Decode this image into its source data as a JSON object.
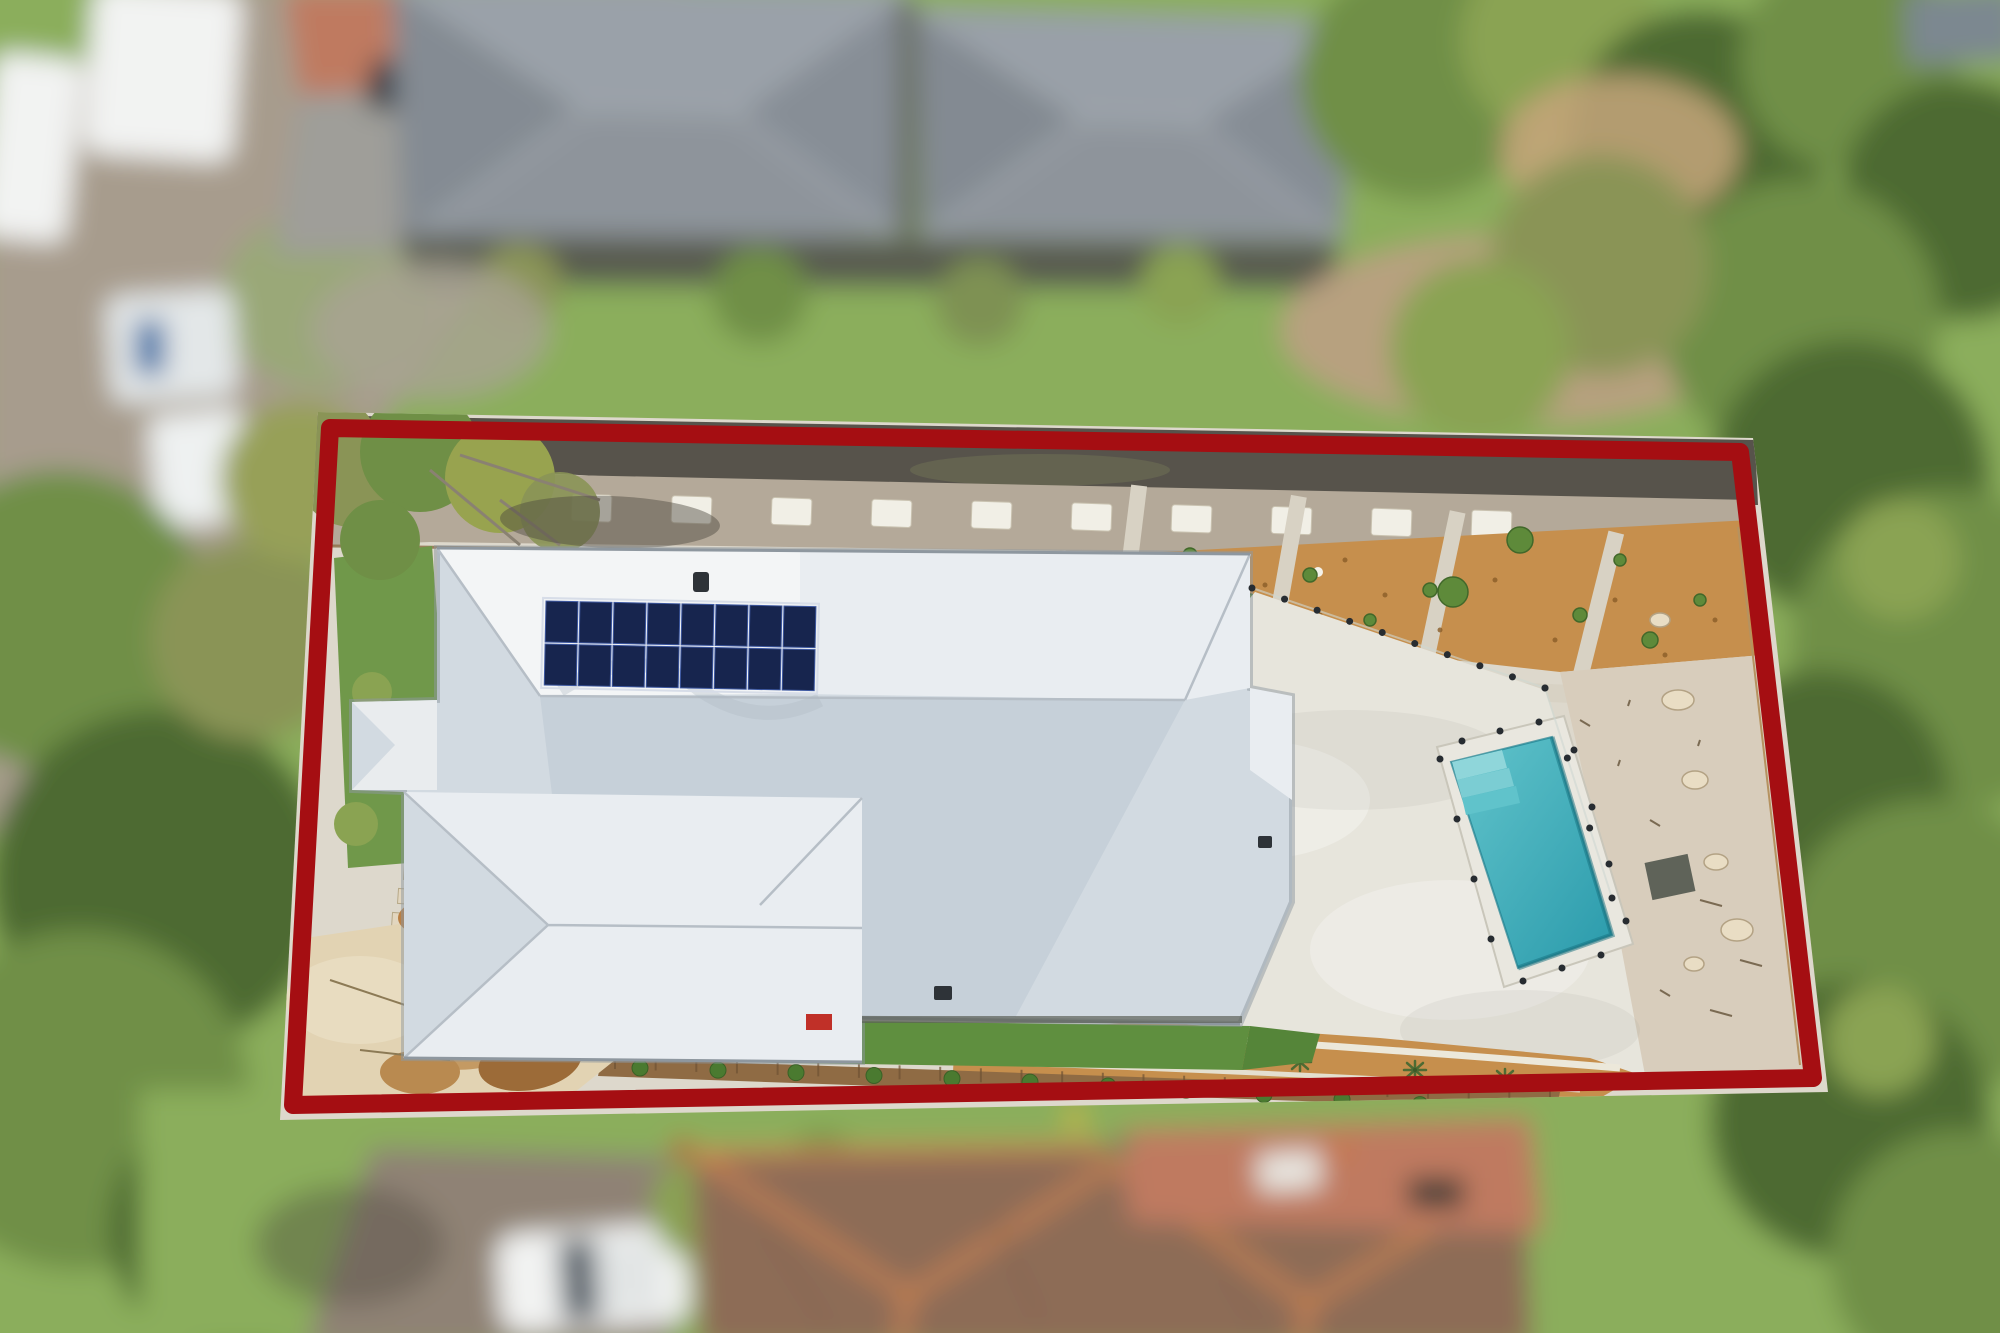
{
  "scene": {
    "kind": "aerial-drone-real-estate-photo",
    "features": [
      "red-property-boundary-outline",
      "white-corrugated-hip-roof-house",
      "rooftop-solar-array",
      "rectangular-swimming-pool-with-steps",
      "glass-pool-fence",
      "concrete-pool-surround",
      "mulch-garden-beds-with-young-plants",
      "gravel-path-with-stepping-stones",
      "lawn-strips",
      "sandstone-rock-outcrop",
      "timber-retaining-wall-with-shrubs",
      "blurred-neighbour-grey-roof-houses",
      "blurred-neighbour-terracotta-tile-roof",
      "blurred-street-with-parked-white-vehicles",
      "blurred-surrounding-trees"
    ]
  },
  "colors": {
    "boundary": "#a50e12",
    "roof_white": "#f3f5f6",
    "roof_light": "#e9edf1",
    "roof_shade": "#d2dae1",
    "roof_deep_shade": "#c6d0d9",
    "roof_edge": "#8e979f",
    "solar_dark": "#17254e",
    "solar_grid": "#3e59a2",
    "pool_water": "#63c5cc",
    "pool_water_deep": "#2a9aab",
    "pool_step": "#8fd6da",
    "coping": "#e9e7df",
    "paving": "#e7e5dc",
    "paving_base": "#ddd8cc",
    "mulch": "#c68f4d",
    "mulch_dark": "#8a5c28",
    "gravel_walk": "#b4a999",
    "gravel_dark": "#57534b",
    "gravel_right": "#d8cdbc",
    "lawn_left": "#70984a",
    "lawn_bottom": "#5f8f3f",
    "lawn_out": "#8bae5c",
    "rock_light": "#e2d3b3",
    "rock_mid": "#c49a63",
    "rock_dark": "#9c6b38",
    "sand": "#edece4",
    "wall_timber": "#8f6b44",
    "shrub": "#4a7a30",
    "plant": "#5e8a3a",
    "road": "#a79c8d",
    "drive": "#9f9e99",
    "drive_bottom": "#8f8274",
    "house_gray": "#8e949b",
    "house_gray_dark": "#7b8189",
    "tile_roof": "#8d6c56",
    "tile_ridge": "#d08550",
    "terracotta": "#bf7a60",
    "tree_dark": "#4e6b33",
    "tree_mid": "#6f8f46",
    "tree_light": "#8aa352",
    "tree_olive": "#8a9456",
    "vehicle_white": "#f2f3f2",
    "shadow": "#4c483f"
  },
  "boundary": {
    "points": "330,428 1740,452 1813,1078 293,1105",
    "stroke_width": 18
  },
  "solar": {
    "x": 546,
    "y": 601,
    "cols": 8,
    "rows": 2,
    "cell_w": 32,
    "cell_h": 41,
    "gap": 2,
    "tilt": 1.2
  },
  "stones": {
    "x0": 472,
    "y0": 492,
    "dx": 100,
    "dy": 1.8,
    "count": 11,
    "w": 40,
    "h": 27
  },
  "fence_lines": [
    {
      "x1": 1252,
      "y1": 588,
      "x2": 1545,
      "y2": 688,
      "posts": 10
    },
    {
      "x1": 1545,
      "y1": 688,
      "x2": 1612,
      "y2": 898,
      "posts": 4
    }
  ],
  "pool": {
    "coping": "1437,747 1564,716 1633,944 1504,987",
    "water": "1451,762 1552,737 1612,935 1518,968",
    "steps": [
      {
        "points": "1452,762 1502,750 1507,768 1457,780",
        "fill": "#8fd6da"
      },
      {
        "points": "1457,780 1509,768 1514,786 1462,798",
        "fill": "#7bcdd3"
      },
      {
        "points": "1462,798 1516,786 1520,803 1466,815",
        "fill": "#60c3cb"
      }
    ],
    "posts": [
      [
        1462,
        741
      ],
      [
        1500,
        731
      ],
      [
        1539,
        722
      ],
      [
        1574,
        750
      ],
      [
        1592,
        807
      ],
      [
        1609,
        864
      ],
      [
        1626,
        921
      ],
      [
        1601,
        955
      ],
      [
        1562,
        968
      ],
      [
        1523,
        981
      ],
      [
        1491,
        939
      ],
      [
        1474,
        879
      ],
      [
        1457,
        819
      ],
      [
        1440,
        759
      ]
    ]
  },
  "mulch_plants": [
    [
      1075,
      570,
      7
    ],
    [
      1130,
      585,
      6
    ],
    [
      1190,
      555,
      7
    ],
    [
      1250,
      600,
      6
    ],
    [
      1310,
      575,
      7
    ],
    [
      1370,
      620,
      6
    ],
    [
      1430,
      590,
      7
    ],
    [
      1453,
      592,
      15
    ],
    [
      1520,
      540,
      13
    ],
    [
      1580,
      615,
      7
    ],
    [
      1650,
      640,
      8
    ],
    [
      1700,
      600,
      6
    ],
    [
      1180,
      620,
      5
    ],
    [
      1290,
      640,
      5
    ],
    [
      1620,
      560,
      6
    ],
    [
      1690,
      680,
      7
    ]
  ],
  "mulch_speckles": [
    [
      1060,
      580
    ],
    [
      1100,
      610
    ],
    [
      1155,
      570
    ],
    [
      1210,
      625
    ],
    [
      1265,
      585
    ],
    [
      1320,
      615
    ],
    [
      1385,
      595
    ],
    [
      1440,
      630
    ],
    [
      1495,
      580
    ],
    [
      1555,
      640
    ],
    [
      1615,
      600
    ],
    [
      1665,
      655
    ],
    [
      1715,
      620
    ],
    [
      1040,
      600
    ],
    [
      1145,
      640
    ],
    [
      1345,
      560
    ],
    [
      1035,
      1060
    ],
    [
      1160,
      1050
    ],
    [
      1260,
      1070
    ],
    [
      1360,
      1055
    ],
    [
      1460,
      1075
    ],
    [
      1540,
      1082
    ]
  ],
  "palms": [
    [
      1100,
      1042
    ],
    [
      1195,
      1052
    ],
    [
      1300,
      1062
    ],
    [
      1415,
      1070
    ],
    [
      1505,
      1078
    ]
  ],
  "shrubs": {
    "x0": 640,
    "y0": 1068,
    "dx": 78,
    "dy": 2.0,
    "count": 12,
    "r": 8
  },
  "wall_ticks": {
    "x0": 615,
    "y0": 1062,
    "x1": 1550,
    "y1": 1096,
    "count": 24
  },
  "rocks_right": [
    [
      1678,
      700,
      16,
      10
    ],
    [
      1695,
      780,
      13,
      9
    ],
    [
      1716,
      862,
      12,
      8
    ],
    [
      1737,
      930,
      16,
      11
    ],
    [
      1694,
      964,
      10,
      7
    ],
    [
      1600,
      940,
      11,
      8
    ],
    [
      1586,
      1010,
      13,
      9
    ],
    [
      1660,
      620,
      10,
      7
    ]
  ],
  "debris": [
    [
      1620,
      760
    ],
    [
      1650,
      820
    ],
    [
      1700,
      900
    ],
    [
      1590,
      870
    ],
    [
      1660,
      990
    ],
    [
      1710,
      1010
    ],
    [
      1630,
      700
    ],
    [
      1580,
      720
    ],
    [
      1740,
      960
    ],
    [
      1700,
      740
    ]
  ]
}
